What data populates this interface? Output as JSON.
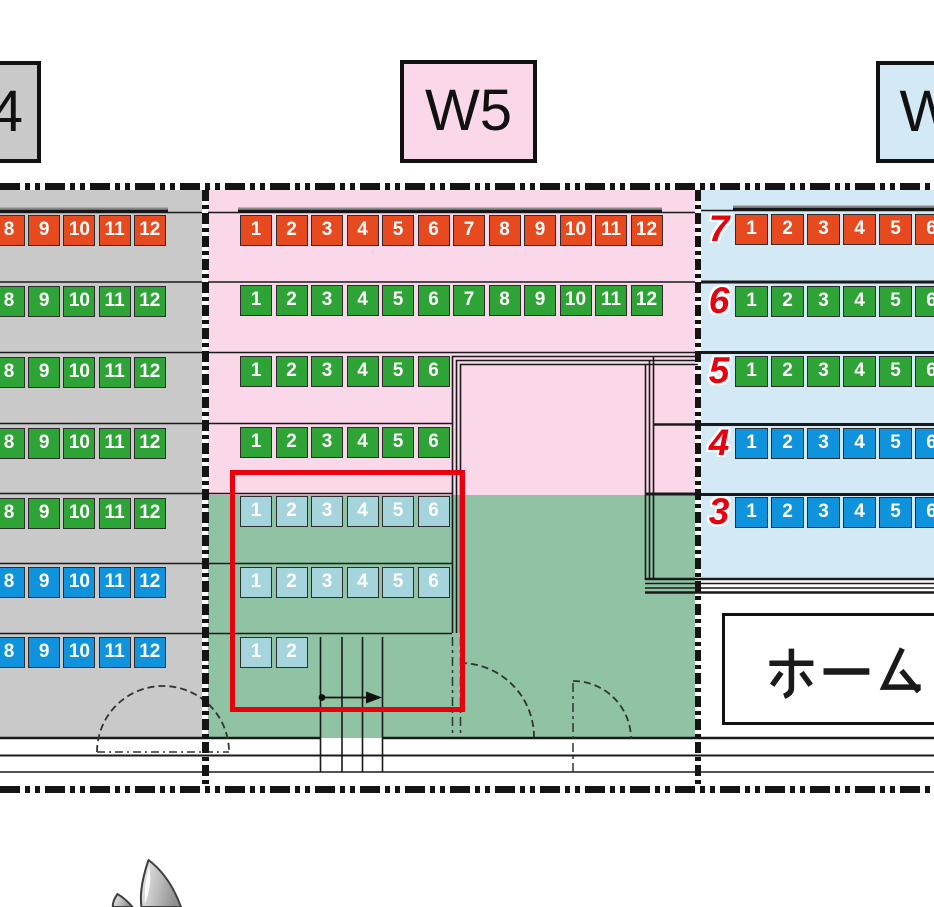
{
  "title_labels": {
    "w4": "W4",
    "w5": "W5",
    "w6": "W6"
  },
  "home_sign": {
    "text": "ホーム"
  },
  "colors": {
    "orange": "#e64a1e",
    "green": "#2ea336",
    "blue": "#0f93dc",
    "lightblue": "#a6d4dd",
    "section_w4_bg": "#c9c9c9",
    "section_w5_pink": "#fbd8e9",
    "section_w5_green": "#8fc3a4",
    "section_w6_bg": "#d3eaf6",
    "highlight_red": "#e8000f",
    "row_label_red": "#e8000f"
  },
  "sections": {
    "left": {
      "label": "W4",
      "rows": [
        {
          "color": "orange",
          "seats": [
            "8",
            "9",
            "10",
            "11",
            "12"
          ]
        },
        {
          "color": "green",
          "seats": [
            "8",
            "9",
            "10",
            "11",
            "12"
          ]
        },
        {
          "color": "green",
          "seats": [
            "8",
            "9",
            "10",
            "11",
            "12"
          ]
        },
        {
          "color": "green",
          "seats": [
            "8",
            "9",
            "10",
            "11",
            "12"
          ]
        },
        {
          "color": "green",
          "seats": [
            "8",
            "9",
            "10",
            "11",
            "12"
          ]
        },
        {
          "color": "blue",
          "seats": [
            "8",
            "9",
            "10",
            "11",
            "12"
          ]
        },
        {
          "color": "blue",
          "seats": [
            "8",
            "9",
            "10",
            "11",
            "12"
          ]
        }
      ]
    },
    "middle": {
      "label": "W5",
      "rows": [
        {
          "color": "orange",
          "seats": [
            "1",
            "2",
            "3",
            "4",
            "5",
            "6",
            "7",
            "8",
            "9",
            "10",
            "11",
            "12"
          ]
        },
        {
          "color": "green",
          "seats": [
            "1",
            "2",
            "3",
            "4",
            "5",
            "6",
            "7",
            "8",
            "9",
            "10",
            "11",
            "12"
          ]
        },
        {
          "color": "green",
          "seats": [
            "1",
            "2",
            "3",
            "4",
            "5",
            "6"
          ]
        },
        {
          "color": "green",
          "seats": [
            "1",
            "2",
            "3",
            "4",
            "5",
            "6"
          ]
        },
        {
          "color": "lightblue",
          "seats": [
            "1",
            "2",
            "3",
            "4",
            "5",
            "6"
          ]
        },
        {
          "color": "lightblue",
          "seats": [
            "1",
            "2",
            "3",
            "4",
            "5",
            "6"
          ]
        },
        {
          "color": "lightblue",
          "seats": [
            "1",
            "2"
          ]
        }
      ]
    },
    "right": {
      "label": "W6",
      "rows": [
        {
          "label": "7",
          "color": "orange",
          "seats": [
            "1",
            "2",
            "3",
            "4",
            "5",
            "6"
          ]
        },
        {
          "label": "6",
          "color": "green",
          "seats": [
            "1",
            "2",
            "3",
            "4",
            "5",
            "6"
          ]
        },
        {
          "label": "5",
          "color": "green",
          "seats": [
            "1",
            "2",
            "3",
            "4",
            "5",
            "6"
          ]
        },
        {
          "label": "4",
          "color": "blue",
          "seats": [
            "1",
            "2",
            "3",
            "4",
            "5",
            "6"
          ]
        },
        {
          "label": "3",
          "color": "blue",
          "seats": [
            "1",
            "2",
            "3",
            "4",
            "5",
            "6"
          ]
        }
      ]
    }
  }
}
